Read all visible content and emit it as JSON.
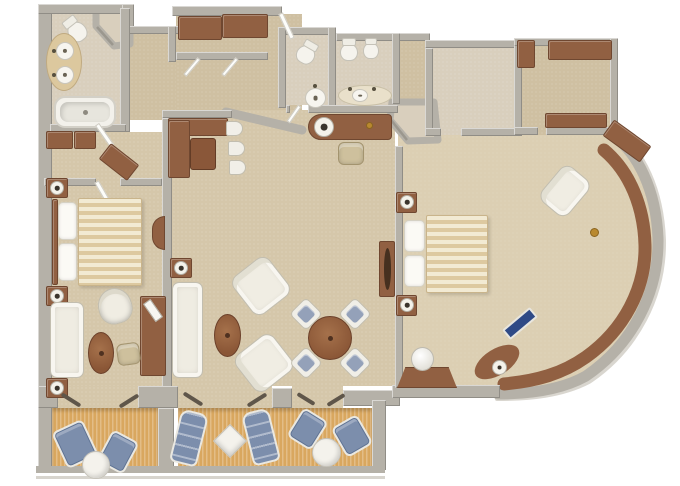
{
  "palette": {
    "wall": "#b5b1a8",
    "carpet1": "#d5c7aa",
    "carpet2": "#dccfb3",
    "carpethall": "#cfc0a2",
    "bathfloor": "#d9cfbd",
    "deck": "#d9a75f",
    "wood": "#916042",
    "blue": "#7c8eac",
    "gold": "#b9892f",
    "white_fixture": "#f4f2ec"
  },
  "plan": {
    "type": "suite-floor-plan",
    "rooms": [
      "master-bathroom",
      "entry-hall",
      "guest-bathroom-1",
      "guest-bathroom-2",
      "bedroom-1",
      "living-dining-room",
      "bathroom-2",
      "walk-in-closet",
      "bedroom-2",
      "balcony-left",
      "balcony-right"
    ]
  },
  "items": [
    {
      "n": "toilet",
      "t": "toilet",
      "x": 68,
      "y": 22,
      "w": 19,
      "h": 20,
      "r": -38
    },
    {
      "n": "vanity-counter",
      "t": "vanA",
      "x": 46,
      "y": 33,
      "w": 36,
      "h": 58
    },
    {
      "n": "sink-basin",
      "t": "basin",
      "x": 56,
      "y": 42,
      "w": 18,
      "h": 18
    },
    {
      "n": "sink-basin",
      "t": "basin",
      "x": 56,
      "y": 66,
      "w": 18,
      "h": 18
    },
    {
      "n": "faucet",
      "t": "dot",
      "x": 52,
      "y": 49,
      "w": 4,
      "h": 4
    },
    {
      "n": "faucet",
      "t": "dot",
      "x": 52,
      "y": 73,
      "w": 4,
      "h": 4
    },
    {
      "n": "bathtub",
      "t": "tub",
      "x": 54,
      "y": 96,
      "w": 62,
      "h": 32
    },
    {
      "n": "door-leaf",
      "t": "doorw",
      "x": 102,
      "y": 122,
      "w": 5,
      "h": 26,
      "r": -35
    },
    {
      "n": "wardrobe",
      "t": "wd",
      "x": 46,
      "y": 131,
      "w": 27,
      "h": 18
    },
    {
      "n": "wardrobe",
      "t": "wd",
      "x": 74,
      "y": 131,
      "w": 22,
      "h": 18
    },
    {
      "n": "dresser-angled",
      "t": "wd",
      "x": 101,
      "y": 152,
      "w": 36,
      "h": 20,
      "r": 38
    },
    {
      "n": "door-leaf",
      "t": "doorw",
      "x": 100,
      "y": 180,
      "w": 5,
      "h": 24,
      "r": -30
    },
    {
      "n": "nightstand",
      "t": "wd",
      "x": 46,
      "y": 178,
      "w": 22,
      "h": 20
    },
    {
      "n": "lamp",
      "t": "lamp",
      "x": 50,
      "y": 181,
      "w": 14,
      "h": 14
    },
    {
      "n": "headboard",
      "t": "wd",
      "x": 52,
      "y": 199,
      "w": 6,
      "h": 86
    },
    {
      "n": "pillow",
      "t": "pillow",
      "x": 58,
      "y": 202,
      "w": 19,
      "h": 38
    },
    {
      "n": "pillow",
      "t": "pillow",
      "x": 58,
      "y": 243,
      "w": 19,
      "h": 38
    },
    {
      "n": "bed-1",
      "t": "bed",
      "x": 78,
      "y": 198,
      "w": 64,
      "h": 88
    },
    {
      "n": "nightstand",
      "t": "wd",
      "x": 46,
      "y": 286,
      "w": 22,
      "h": 20
    },
    {
      "n": "lamp",
      "t": "lamp",
      "x": 50,
      "y": 289,
      "w": 14,
      "h": 14
    },
    {
      "n": "sofa",
      "t": "sofa",
      "x": 50,
      "y": 302,
      "w": 34,
      "h": 76
    },
    {
      "n": "end-table",
      "t": "wd",
      "x": 46,
      "y": 378,
      "w": 22,
      "h": 20
    },
    {
      "n": "lamp",
      "t": "lamp",
      "x": 50,
      "y": 381,
      "w": 14,
      "h": 14
    },
    {
      "n": "barrel-chair",
      "t": "barrel",
      "x": 98,
      "y": 288,
      "w": 34,
      "h": 36,
      "r": -15
    },
    {
      "n": "coffee-table",
      "t": "tblo",
      "x": 88,
      "y": 332,
      "w": 26,
      "h": 42
    },
    {
      "n": "tv-cabinet",
      "t": "wd",
      "x": 140,
      "y": 296,
      "w": 26,
      "h": 80
    },
    {
      "n": "tv",
      "t": "tv",
      "x": 142,
      "y": 306,
      "w": 22,
      "h": 9,
      "r": 55
    },
    {
      "n": "desk-chair",
      "t": "chairbg",
      "x": 117,
      "y": 343,
      "w": 23,
      "h": 22,
      "r": -8
    },
    {
      "n": "half-moon-console",
      "t": "halfmoon",
      "x": 152,
      "y": 216,
      "w": 13,
      "h": 34
    },
    {
      "n": "wardrobe",
      "t": "wd",
      "x": 178,
      "y": 16,
      "w": 44,
      "h": 24
    },
    {
      "n": "wardrobe",
      "t": "wd",
      "x": 222,
      "y": 14,
      "w": 46,
      "h": 24
    },
    {
      "n": "door-leaf",
      "t": "doorw",
      "x": 190,
      "y": 56,
      "w": 4,
      "h": 22,
      "r": 40
    },
    {
      "n": "door-leaf",
      "t": "doorw",
      "x": 228,
      "y": 56,
      "w": 4,
      "h": 22,
      "r": 40
    },
    {
      "n": "entry-door-leaf",
      "t": "doorw",
      "x": 284,
      "y": 12,
      "w": 5,
      "h": 28,
      "r": -25
    },
    {
      "n": "toilet",
      "t": "toilet",
      "x": 296,
      "y": 46,
      "w": 19,
      "h": 18,
      "r": 30
    },
    {
      "n": "pedestal-sink",
      "t": "basin",
      "x": 305,
      "y": 88,
      "w": 21,
      "h": 20
    },
    {
      "n": "faucet",
      "t": "dot",
      "x": 313,
      "y": 84,
      "w": 4,
      "h": 4
    },
    {
      "n": "door-leaf",
      "t": "doorw",
      "x": 292,
      "y": 104,
      "w": 4,
      "h": 20,
      "r": 35
    },
    {
      "n": "toilet",
      "t": "toilet",
      "x": 340,
      "y": 44,
      "w": 18,
      "h": 17
    },
    {
      "n": "bidet",
      "t": "toilet",
      "x": 363,
      "y": 43,
      "w": 16,
      "h": 16
    },
    {
      "n": "vanity-counter",
      "t": "vanB",
      "x": 338,
      "y": 85,
      "w": 54,
      "h": 21
    },
    {
      "n": "sink-basin",
      "t": "basin",
      "x": 352,
      "y": 89,
      "w": 16,
      "h": 13
    },
    {
      "n": "faucet",
      "t": "dot",
      "x": 348,
      "y": 87,
      "w": 4,
      "h": 4
    },
    {
      "n": "faucet",
      "t": "dot",
      "x": 372,
      "y": 87,
      "w": 4,
      "h": 4
    },
    {
      "n": "writing-desk",
      "t": "desk",
      "x": 308,
      "y": 114,
      "w": 84,
      "h": 26
    },
    {
      "n": "desk-lamp",
      "t": "lamp",
      "x": 314,
      "y": 117,
      "w": 20,
      "h": 20
    },
    {
      "n": "gold-accent",
      "t": "gold",
      "x": 366,
      "y": 122,
      "w": 7,
      "h": 7
    },
    {
      "n": "desk-chair",
      "t": "chairbg",
      "x": 338,
      "y": 142,
      "w": 26,
      "h": 23
    },
    {
      "n": "banquette",
      "t": "wd",
      "x": 168,
      "y": 118,
      "w": 60,
      "h": 18
    },
    {
      "n": "banquette",
      "t": "wd",
      "x": 168,
      "y": 120,
      "w": 22,
      "h": 58
    },
    {
      "n": "nook-table",
      "t": "wdd",
      "x": 190,
      "y": 138,
      "w": 26,
      "h": 32
    },
    {
      "n": "nook-chair",
      "t": "stoolw",
      "x": 226,
      "y": 121,
      "w": 17,
      "h": 15
    },
    {
      "n": "nook-chair",
      "t": "stoolw",
      "x": 228,
      "y": 141,
      "w": 17,
      "h": 15
    },
    {
      "n": "nook-chair",
      "t": "stoolw",
      "x": 229,
      "y": 160,
      "w": 17,
      "h": 15
    },
    {
      "n": "end-table",
      "t": "wd",
      "x": 170,
      "y": 258,
      "w": 22,
      "h": 20
    },
    {
      "n": "lamp",
      "t": "lamp",
      "x": 174,
      "y": 261,
      "w": 14,
      "h": 14
    },
    {
      "n": "sofa",
      "t": "sofa",
      "x": 172,
      "y": 282,
      "w": 31,
      "h": 96
    },
    {
      "n": "armchair",
      "t": "armchair",
      "x": 238,
      "y": 262,
      "w": 46,
      "h": 48,
      "r": -38
    },
    {
      "n": "armchair",
      "t": "armchair",
      "x": 241,
      "y": 339,
      "w": 46,
      "h": 48,
      "r": -128
    },
    {
      "n": "coffee-table",
      "t": "tblo",
      "x": 214,
      "y": 314,
      "w": 27,
      "h": 43
    },
    {
      "n": "dining-table",
      "t": "tblr",
      "x": 308,
      "y": 316,
      "w": 44,
      "h": 44
    },
    {
      "n": "dining-chair",
      "t": "dchair",
      "x": 294,
      "y": 302,
      "w": 24,
      "h": 24,
      "r": 45
    },
    {
      "n": "dining-chair",
      "t": "dchair",
      "x": 343,
      "y": 302,
      "w": 24,
      "h": 24,
      "r": 45
    },
    {
      "n": "dining-chair",
      "t": "dchair",
      "x": 294,
      "y": 351,
      "w": 24,
      "h": 24,
      "r": 45
    },
    {
      "n": "dining-chair",
      "t": "dchair",
      "x": 343,
      "y": 351,
      "w": 24,
      "h": 24,
      "r": 45
    },
    {
      "n": "console-table",
      "t": "consoleb",
      "x": 379,
      "y": 241,
      "w": 16,
      "h": 56
    },
    {
      "n": "nightstand",
      "t": "wd",
      "x": 396,
      "y": 192,
      "w": 21,
      "h": 21
    },
    {
      "n": "lamp",
      "t": "lamp",
      "x": 400,
      "y": 195,
      "w": 14,
      "h": 14
    },
    {
      "n": "pillow",
      "t": "pillow",
      "x": 404,
      "y": 220,
      "w": 21,
      "h": 32
    },
    {
      "n": "pillow",
      "t": "pillow",
      "x": 404,
      "y": 255,
      "w": 21,
      "h": 32
    },
    {
      "n": "bed-2",
      "t": "bed",
      "x": 426,
      "y": 215,
      "w": 62,
      "h": 78
    },
    {
      "n": "nightstand",
      "t": "wd",
      "x": 396,
      "y": 295,
      "w": 21,
      "h": 21
    },
    {
      "n": "lamp",
      "t": "lamp",
      "x": 400,
      "y": 298,
      "w": 14,
      "h": 14
    },
    {
      "n": "armchair",
      "t": "armchair",
      "x": 542,
      "y": 173,
      "w": 46,
      "h": 36,
      "r": -50
    },
    {
      "n": "corner-cabinet",
      "t": "wd",
      "x": 604,
      "y": 131,
      "w": 46,
      "h": 20,
      "r": 36
    },
    {
      "n": "window-ledge-cushion",
      "t": "inlay",
      "x": 502,
      "y": 317,
      "w": 36,
      "h": 13,
      "r": -40
    },
    {
      "n": "ledge-lamp",
      "t": "lamp",
      "x": 492,
      "y": 360,
      "w": 15,
      "h": 15
    },
    {
      "n": "gold-accent",
      "t": "gold",
      "x": 590,
      "y": 228,
      "w": 9,
      "h": 9
    },
    {
      "n": "vanity-desk",
      "t": "trap",
      "x": 397,
      "y": 367,
      "w": 60,
      "h": 21
    },
    {
      "n": "vanity-stool",
      "t": "cyl",
      "x": 411,
      "y": 347,
      "w": 23,
      "h": 24
    },
    {
      "n": "wardrobe",
      "t": "wd",
      "x": 517,
      "y": 40,
      "w": 18,
      "h": 28
    },
    {
      "n": "wardrobe",
      "t": "wd",
      "x": 548,
      "y": 40,
      "w": 64,
      "h": 20
    },
    {
      "n": "closet-bench",
      "t": "wd",
      "x": 545,
      "y": 113,
      "w": 62,
      "h": 15
    },
    {
      "n": "balcony-chair",
      "t": "bluechair",
      "x": 58,
      "y": 424,
      "w": 34,
      "h": 40,
      "r": -25
    },
    {
      "n": "balcony-chair",
      "t": "bluechair",
      "x": 103,
      "y": 434,
      "w": 30,
      "h": 36,
      "r": 28
    },
    {
      "n": "balcony-table",
      "t": "tblw",
      "x": 82,
      "y": 451,
      "w": 28,
      "h": 28
    },
    {
      "n": "lounger",
      "t": "lounger",
      "x": 175,
      "y": 411,
      "w": 28,
      "h": 54,
      "r": 14
    },
    {
      "n": "diamond-table",
      "t": "diam",
      "x": 218,
      "y": 429,
      "w": 24,
      "h": 24,
      "r": 45
    },
    {
      "n": "lounger",
      "t": "lounger",
      "x": 247,
      "y": 410,
      "w": 28,
      "h": 54,
      "r": -14
    },
    {
      "n": "balcony-chair",
      "t": "bluechair",
      "x": 293,
      "y": 412,
      "w": 29,
      "h": 34,
      "r": 32
    },
    {
      "n": "balcony-table",
      "t": "tblw",
      "x": 312,
      "y": 438,
      "w": 29,
      "h": 29
    },
    {
      "n": "balcony-chair",
      "t": "bluechair",
      "x": 337,
      "y": 419,
      "w": 30,
      "h": 34,
      "r": -30
    },
    {
      "n": "balcony-door-leaf",
      "t": "leafd",
      "x": 60,
      "y": 398,
      "w": 22,
      "h": 4,
      "r": 32
    },
    {
      "n": "balcony-door-leaf",
      "t": "leafd",
      "x": 118,
      "y": 399,
      "w": 22,
      "h": 4,
      "r": -32
    },
    {
      "n": "balcony-door-leaf",
      "t": "leafd",
      "x": 182,
      "y": 397,
      "w": 22,
      "h": 4,
      "r": 32
    },
    {
      "n": "balcony-door-leaf",
      "t": "leafd",
      "x": 246,
      "y": 398,
      "w": 22,
      "h": 4,
      "r": -32
    },
    {
      "n": "balcony-door-leaf",
      "t": "leafd",
      "x": 296,
      "y": 397,
      "w": 20,
      "h": 4,
      "r": 32
    },
    {
      "n": "balcony-door-leaf",
      "t": "leafd",
      "x": 326,
      "y": 398,
      "w": 20,
      "h": 4,
      "r": -32
    }
  ]
}
